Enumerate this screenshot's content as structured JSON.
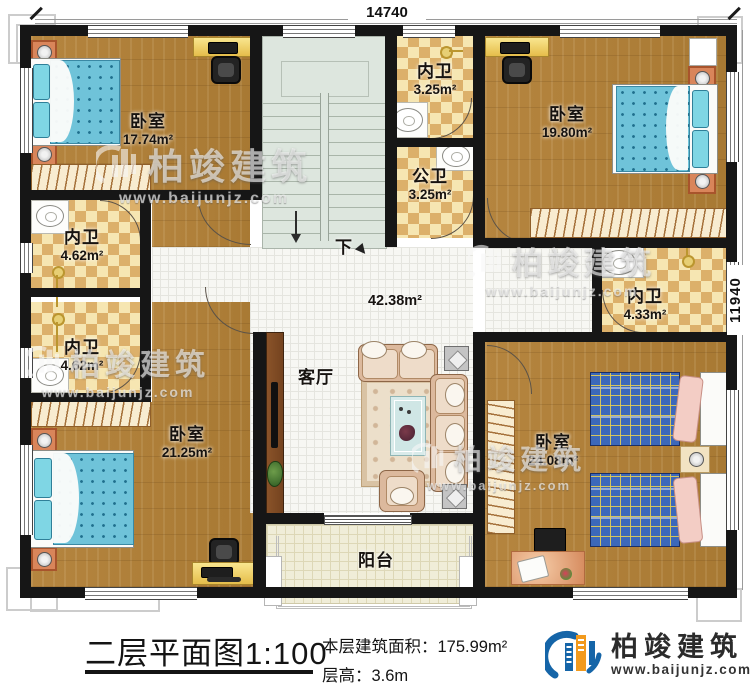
{
  "doc": {
    "dimension_top": "14740",
    "dimension_right": "11940",
    "stair_direction": "下"
  },
  "rooms": {
    "bedroom_tl": {
      "name": "卧室",
      "area": "17.74m²"
    },
    "bath_top": {
      "name": "内卫",
      "area": "3.25m²"
    },
    "bath_public": {
      "name": "公卫",
      "area": "3.25m²"
    },
    "bedroom_tr": {
      "name": "卧室",
      "area": "19.80m²"
    },
    "bath_left_upper": {
      "name": "内卫",
      "area": "4.62m²"
    },
    "bath_left_lower": {
      "name": "内卫",
      "area": "4.62m²"
    },
    "living": {
      "name": "客厅",
      "area": "42.38m²"
    },
    "bath_right": {
      "name": "内卫",
      "area": "4.33m²"
    },
    "bedroom_bl": {
      "name": "卧室",
      "area": "21.25m²"
    },
    "bedroom_br": {
      "name": "卧室",
      "area": "24.08m²"
    },
    "balcony": {
      "name": "阳台"
    }
  },
  "title_block": {
    "plan_title": "二层平面图",
    "scale": "1:100",
    "area_caption": "本层建筑面积：",
    "area_value": "175.99m²",
    "floor_height_caption": "层高：",
    "floor_height_value": "3.6m"
  },
  "brand": {
    "name": "柏竣建筑",
    "website": "www.baijunjz.com"
  }
}
